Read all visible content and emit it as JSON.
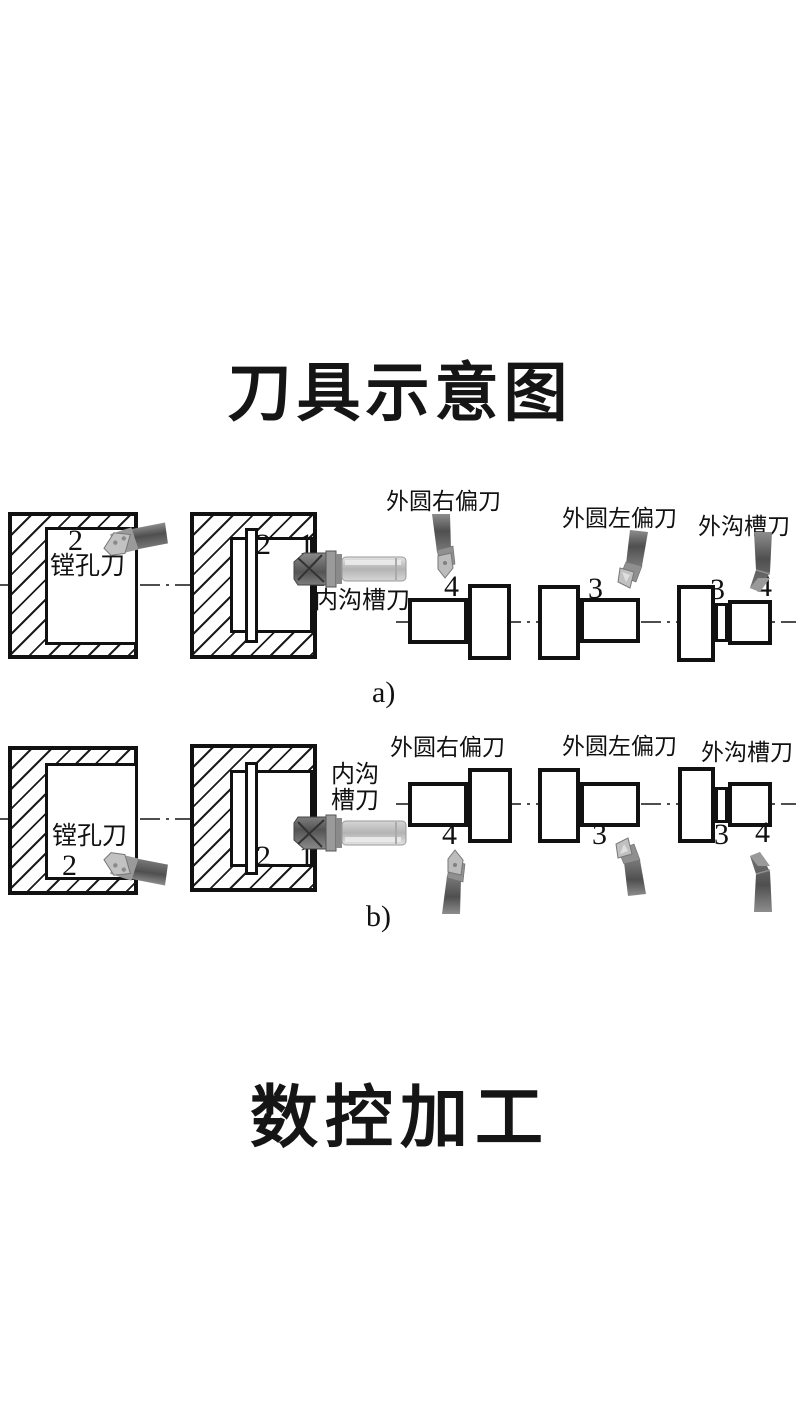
{
  "title": "刀具示意图",
  "footer_title": "数控加工",
  "captions": {
    "a": "a)",
    "b": "b)"
  },
  "tools": {
    "boring_label": "镗孔刀",
    "internal_groove_label": "内沟槽刀",
    "internal_groove_label_line1": "内沟",
    "internal_groove_label_line2": "槽刀",
    "right_offset_label": "外圆右偏刀",
    "left_offset_label": "外圆左偏刀",
    "external_groove_label": "外沟槽刀"
  },
  "numbers": {
    "boring": "2",
    "groove_slot": "2",
    "bore_entry": "1",
    "step_right": "4",
    "step_left": "3",
    "ext_groove_step": "3",
    "ext_groove_end": "4"
  },
  "colors": {
    "ink": "#111111",
    "centerline": "#4e4e4e",
    "tool_dark": "#5a5a5a",
    "tool_light": "#c0c0c0",
    "background": "#ffffff"
  }
}
